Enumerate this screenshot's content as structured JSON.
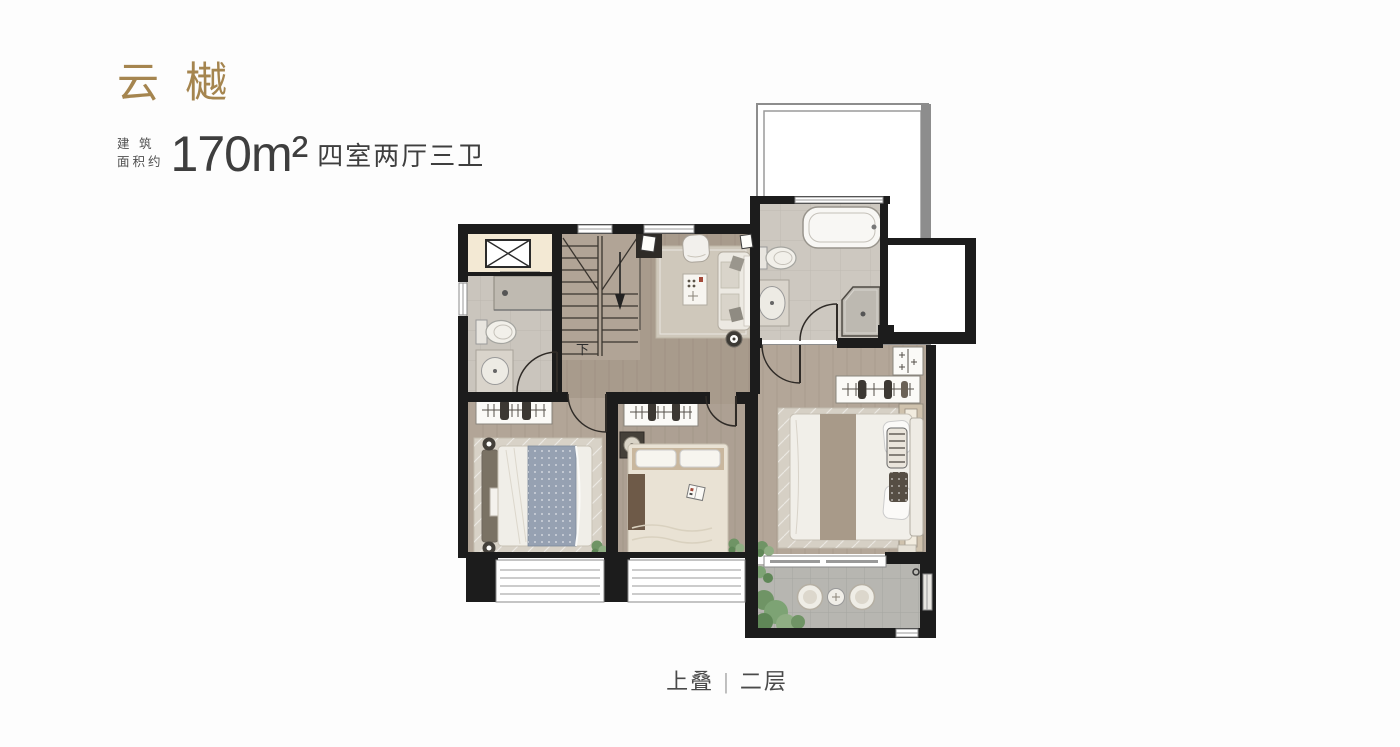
{
  "header": {
    "project_name": "云樾",
    "area_prefix_line1": "建 筑",
    "area_prefix_line2": "面积约",
    "area_value": "170m²",
    "layout": "四室两厅三卫"
  },
  "plan": {
    "stair_label": "下"
  },
  "footer": {
    "stack_label": "上叠",
    "separator": "|",
    "floor_label": "二层"
  },
  "theme": {
    "accent": "#a5854f",
    "text_dark": "#3e3e3e",
    "text_mid": "#4a4a4a",
    "wall_black": "#1c1c1c",
    "floor_wood": "#a89b8c",
    "floor_bedroom": "#b2a597",
    "bath_tile": "#cac5bd",
    "balcony_tile": "#b7b6b1",
    "elevator_cream": "#f3e9d4",
    "terrace_border_gray": "#8d8d8d",
    "rug": "#d6d0c5",
    "blanket_blue": "#96a1b2",
    "blanket_tan": "#c9b79e",
    "plant_green": "#7da374"
  }
}
